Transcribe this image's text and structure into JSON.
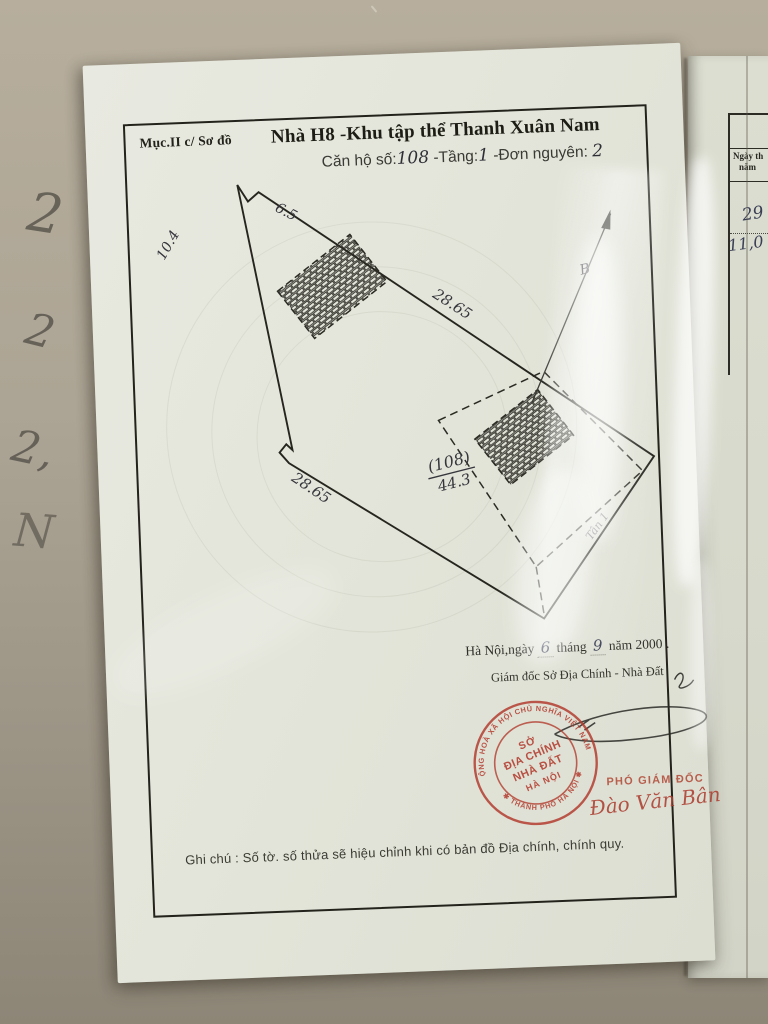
{
  "page": {
    "section_label": "Mục.II c/ Sơ đồ",
    "title": "Nhà H8 -Khu tập thể Thanh Xuân Nam",
    "subtitle_prefix": "Căn hộ số:",
    "apartment_no": "108",
    "floor_label": "-Tầng:",
    "floor_no": "1",
    "unit_label": "-Đơn nguyên:",
    "unit_no": "2",
    "note": "Ghi chú : Số tờ. số thửa sẽ hiệu chỉnh khi có bản đồ Địa chính, chính quy."
  },
  "diagram": {
    "measurements": {
      "top_notch": "6.5",
      "upper_left": "10.4",
      "upper_right": "28.65",
      "lower_left": "28.65"
    },
    "parcel": {
      "number": "(108)",
      "area": "44.3"
    },
    "north_label": "B",
    "side_note": "Tân 1"
  },
  "signing": {
    "place_date": {
      "prefix": "Hà Nội,ngày",
      "day": "6",
      "mid": "tháng",
      "month": "9",
      "suffix": "năm 2000 ."
    },
    "authority": "Giám đốc Sở Địa Chính - Nhà Đất",
    "deputy_title": "PHÓ GIÁM ĐỐC",
    "deputy_name": "Đào Văn Bân"
  },
  "stamp": {
    "ring_top": "CỘNG HOÀ XÃ HỘI CHỦ NGHĨA VIỆT NAM",
    "ring_bottom": "✱ THÀNH PHỐ HÀ NỘI ✱",
    "line1": "SỞ",
    "line2": "ĐỊA CHÍNH",
    "line3": "NHÀ ĐẤT",
    "line4": "HÀ NỘI",
    "color": "#b23a2c"
  },
  "right_page": {
    "header_line1": "Ngày th",
    "header_line2": "năm",
    "entry1": "29",
    "entry2": "11,0"
  },
  "background_marks": [
    "2",
    "2",
    "2,",
    "N"
  ],
  "colors": {
    "paper": "#e4e5db",
    "ink": "#26261f",
    "pen": "#35363c",
    "stamp_red": "#b23a2c",
    "background": "#aaa293"
  }
}
